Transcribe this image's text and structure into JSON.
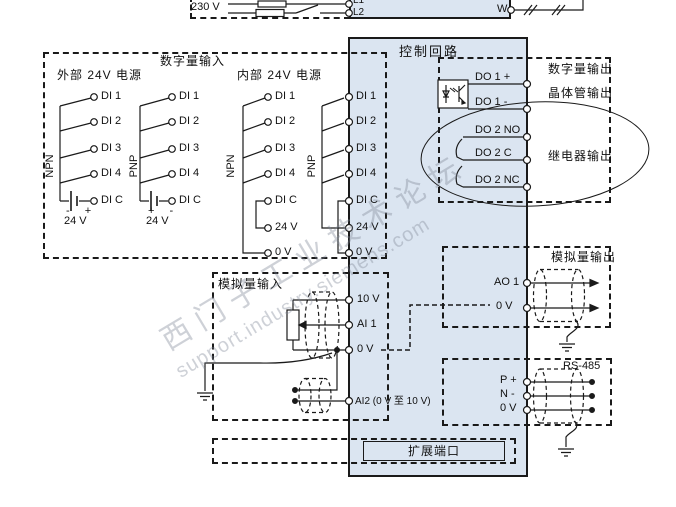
{
  "power": {
    "voltage": "230 V",
    "l1": "L1",
    "l2": "L2",
    "w": "W"
  },
  "control": {
    "title": "控制回路",
    "expansion_port": "扩展端口"
  },
  "digital_input": {
    "title": "数字量输入",
    "external_supply": "外部 24V 电源",
    "internal_supply": "内部 24V 电源",
    "npn": "NPN",
    "pnp": "PNP",
    "di1": "DI 1",
    "di2": "DI 2",
    "di3": "DI 3",
    "di4": "DI 4",
    "dic": "DI C",
    "v24": "24 V",
    "v0": "0 V",
    "polarity_npn": "- +",
    "polarity_pnp": "+ -"
  },
  "control_terminals": {
    "di1": "DI 1",
    "di2": "DI 2",
    "di3": "DI 3",
    "di4": "DI 4",
    "dic": "DI C",
    "v24": "24 V",
    "v0": "0 V"
  },
  "digital_output": {
    "title": "数字量输出",
    "transistor": "晶体管输出",
    "relay": "继电器输出",
    "do1p": "DO 1 +",
    "do1m": "DO 1 -",
    "do2no": "DO 2 NO",
    "do2c": "DO 2 C",
    "do2nc": "DO 2 NC"
  },
  "analog_output": {
    "title": "模拟量输出",
    "ao1": "AO 1",
    "v0": "0 V"
  },
  "rs485": {
    "title": "RS-485",
    "p": "P +",
    "n": "N -",
    "v0": "0 V"
  },
  "analog_input": {
    "title": "模拟量输入",
    "v10": "10 V",
    "ai1": "AI 1",
    "v0": "0 V",
    "ai2": "AI2 (0 V 至 10 V)"
  },
  "watermark": {
    "line1": "西门子工业技术论坛",
    "line2": "support.industry.siemens.com"
  },
  "colors": {
    "panel_fill": "#dbe5f1",
    "line": "#1a1a1a"
  }
}
